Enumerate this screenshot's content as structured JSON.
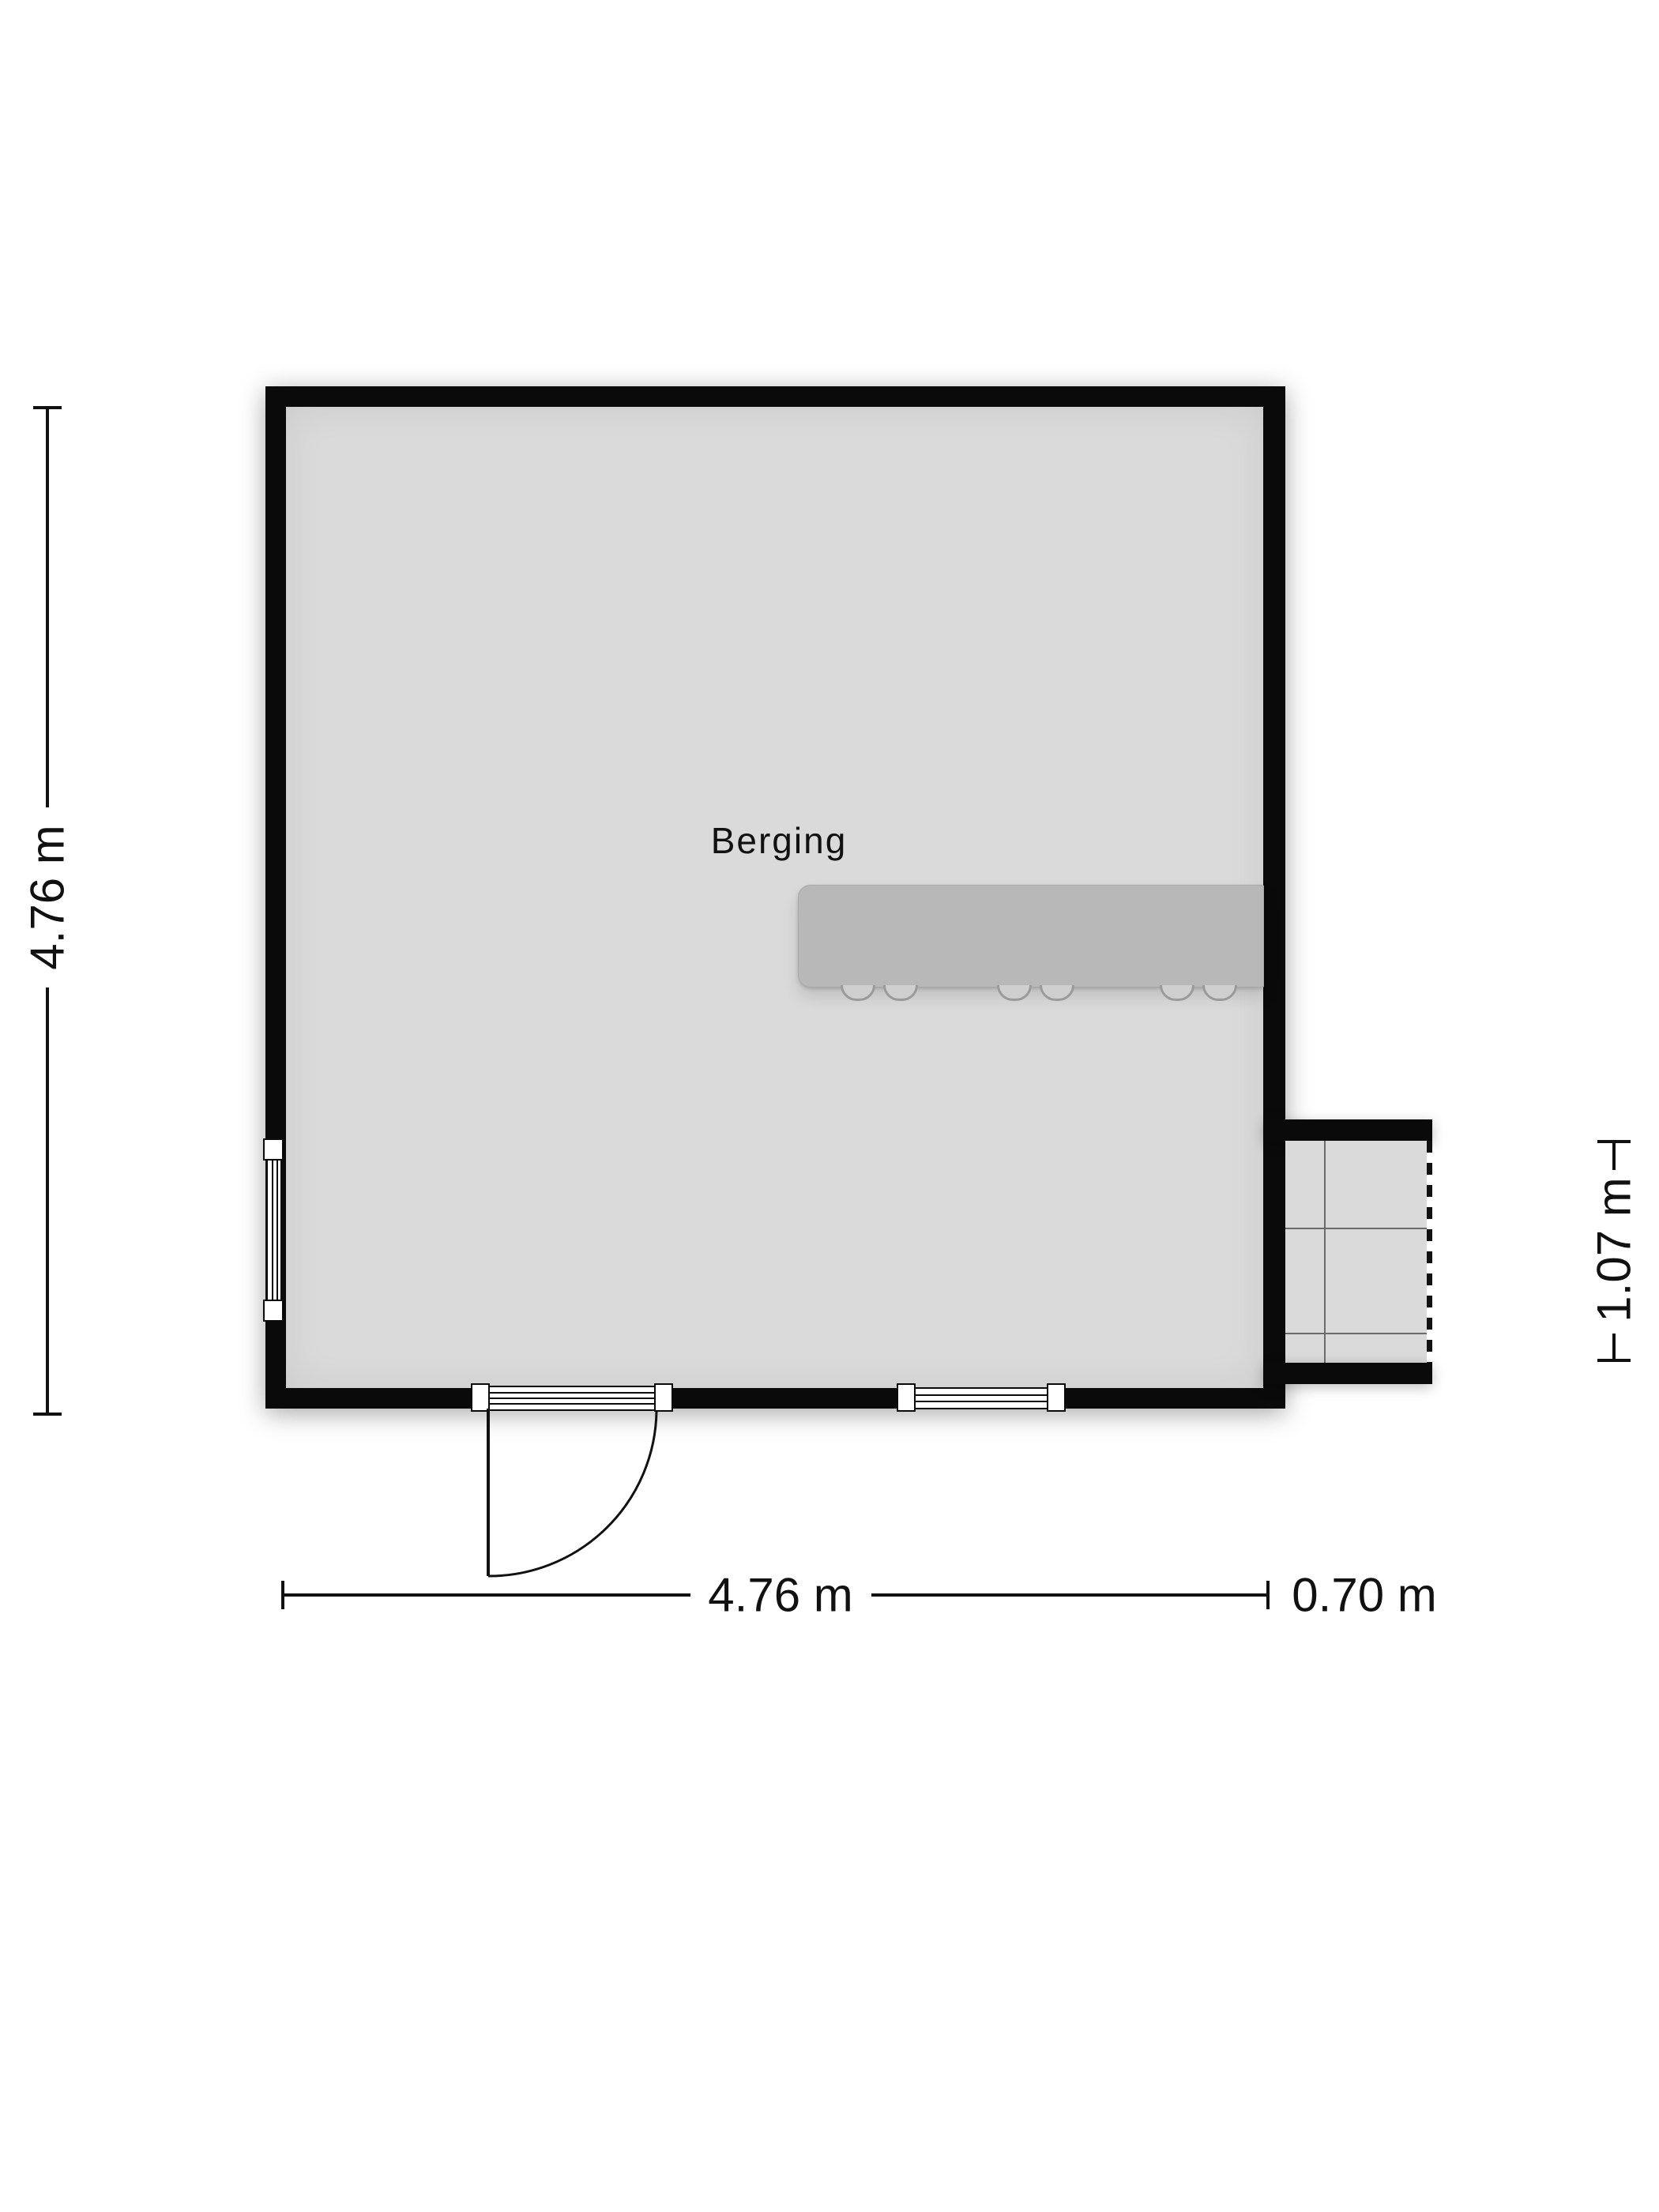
{
  "floorplan": {
    "room": {
      "label": "Berging"
    },
    "dimensions": {
      "main_height": "4.76 m",
      "main_width": "4.76 m",
      "extension_width": "0.70 m",
      "extension_height": "1.07 m"
    },
    "colors": {
      "wall": "#0a0a0a",
      "floor": "#dadada",
      "counter": "#b8b8b8",
      "bg": "#ffffff",
      "ink": "#111111"
    }
  }
}
